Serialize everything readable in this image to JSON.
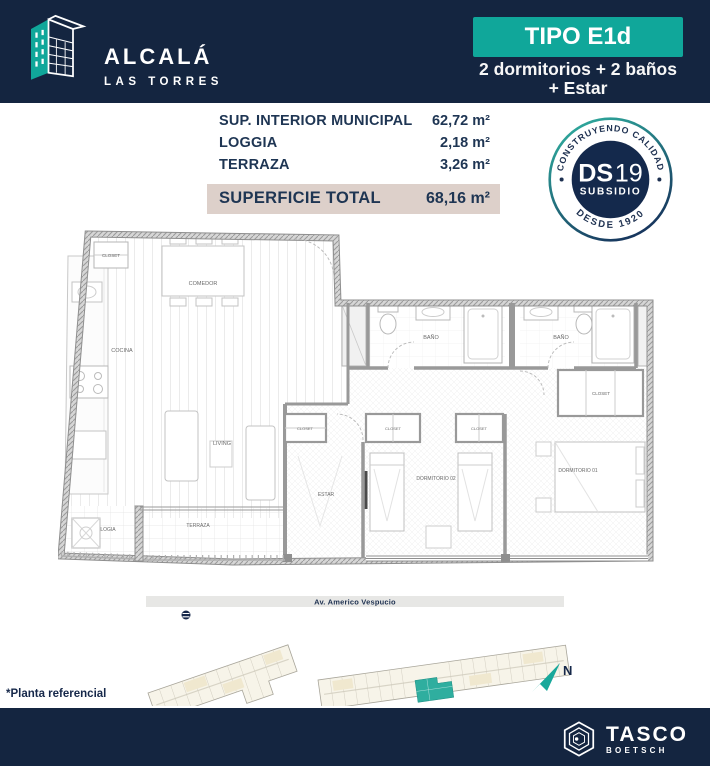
{
  "header": {
    "brand_name": "ALCALÁ",
    "brand_subtitle": "LAS TORRES",
    "type_badge": "TIPO E1d",
    "type_line1": "2 dormitorios + 2 baños",
    "type_line2": "+ Estar"
  },
  "surfaces": {
    "rows": [
      {
        "label": "SUP. INTERIOR MUNICIPAL",
        "value": "62,72 m²"
      },
      {
        "label": "LOGGIA",
        "value": "2,18 m²"
      },
      {
        "label": "TERRAZA",
        "value": "3,26 m²"
      }
    ],
    "total": {
      "label": "SUPERFICIE TOTAL",
      "value": "68,16 m²"
    }
  },
  "seal": {
    "arc_top": "CONSTRUYENDO CALIDAD",
    "arc_bottom": "DESDE 1920",
    "main": "DS",
    "main_num": "19",
    "sub": "SUBSIDIO"
  },
  "floorplan": {
    "rooms": {
      "closet_entry": "CLOSET",
      "comedor": "COMEDOR",
      "cocina": "COCINA",
      "living": "LIVING",
      "bano_1": "BAÑO",
      "bano_2": "BAÑO",
      "closet_dorm1": "CLOSET",
      "closet_hall": "CLOSET",
      "closet_dorm2_a": "CLOSET",
      "closet_dorm2_b": "CLOSET",
      "dormitorio_2": "DORMITORIO 02",
      "dormitorio_1": "DORMITORIO 01",
      "estar": "ESTAR",
      "terraza": "TERRAZA",
      "logia": "LOGIA"
    }
  },
  "siteplan": {
    "street": "Av. Americo Vespucio",
    "compass": "N"
  },
  "footnote": "*Planta referencial",
  "footer": {
    "brand": "TASCO",
    "brand_sub": "BOETSCH"
  },
  "colors": {
    "navy": "#142540",
    "teal": "#10A79A",
    "beige_highlight": "#DDD0CA",
    "seal_navy": "#14294C",
    "unit_highlight": "#2FAE9F"
  }
}
